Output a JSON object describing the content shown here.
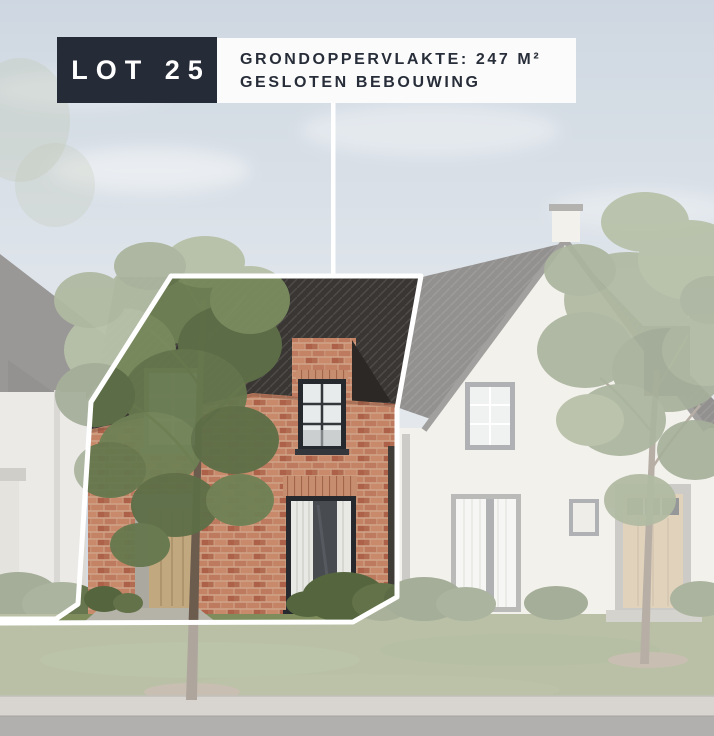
{
  "badge": {
    "label": "LOT 25"
  },
  "info": {
    "area": "GRONDOPPERVLAKTE: 247 M²",
    "type": "GESLOTEN BEBOUWING"
  },
  "colors": {
    "badge_bg": "#252b37",
    "badge_text": "#ffffff",
    "panel_bg": "#fbfbfb",
    "panel_text": "#272d39",
    "lot_outline": "#ffffff",
    "brick": "#c07a5e",
    "dark_roof": "#393634",
    "sky": "#c9d3dd",
    "grass": "#7f8d5c"
  }
}
